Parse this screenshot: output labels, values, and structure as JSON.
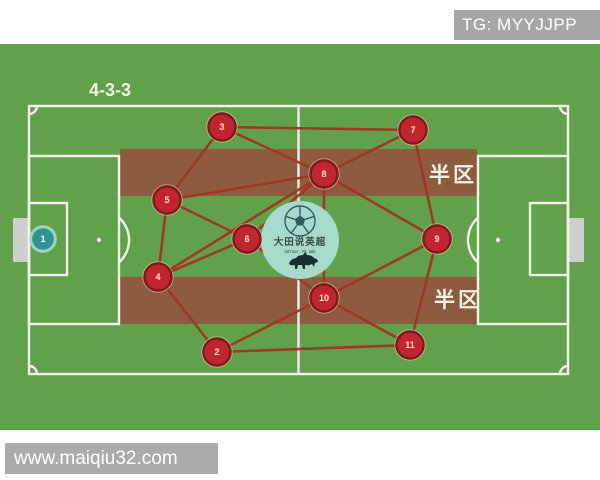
{
  "banners": {
    "top_right": "TG: MYYJJPP",
    "bottom_left": "www.maiqiu32.com"
  },
  "formation": {
    "label": "4-3-3"
  },
  "zones": [
    "半区",
    "半区"
  ],
  "logo": {
    "title": "大田说英超",
    "subtitle": "daTian - PL talk"
  },
  "colors": {
    "field": "#61a14b",
    "stripe": "#8d5b3e",
    "line_white": "#f2f1ea",
    "goal": "#cfcfcf",
    "edge": "#a23522",
    "player_fill": "#c2252e",
    "player_border": "#7e191d",
    "player_ring": "#e9d3a8",
    "player_number": "#ffe8d0",
    "gk_fill": "#2f9390",
    "gk_border": "#90d9d0",
    "logo_bg": "#a7dacb",
    "logo_ink": "#2d5f5a"
  },
  "players": [
    {
      "number": "1",
      "x": 43,
      "y": 239,
      "role": "goalkeeper"
    },
    {
      "number": "2",
      "x": 217,
      "y": 352,
      "role": "defender"
    },
    {
      "number": "3",
      "x": 222,
      "y": 127,
      "role": "defender"
    },
    {
      "number": "4",
      "x": 158,
      "y": 277,
      "role": "defender"
    },
    {
      "number": "5",
      "x": 167,
      "y": 200,
      "role": "defender"
    },
    {
      "number": "6",
      "x": 247,
      "y": 239,
      "role": "midfielder"
    },
    {
      "number": "7",
      "x": 413,
      "y": 130,
      "role": "forward"
    },
    {
      "number": "8",
      "x": 324,
      "y": 174,
      "role": "midfielder"
    },
    {
      "number": "9",
      "x": 437,
      "y": 239,
      "role": "forward"
    },
    {
      "number": "10",
      "x": 324,
      "y": 298,
      "role": "midfielder"
    },
    {
      "number": "11",
      "x": 410,
      "y": 345,
      "role": "forward"
    }
  ],
  "edges": [
    [
      3,
      7
    ],
    [
      3,
      5
    ],
    [
      3,
      8
    ],
    [
      5,
      4
    ],
    [
      5,
      6
    ],
    [
      5,
      8
    ],
    [
      4,
      6
    ],
    [
      4,
      8
    ],
    [
      4,
      2
    ],
    [
      6,
      8
    ],
    [
      6,
      10
    ],
    [
      8,
      7
    ],
    [
      8,
      9
    ],
    [
      8,
      10
    ],
    [
      9,
      7
    ],
    [
      9,
      10
    ],
    [
      9,
      11
    ],
    [
      10,
      2
    ],
    [
      10,
      11
    ],
    [
      2,
      11
    ]
  ]
}
